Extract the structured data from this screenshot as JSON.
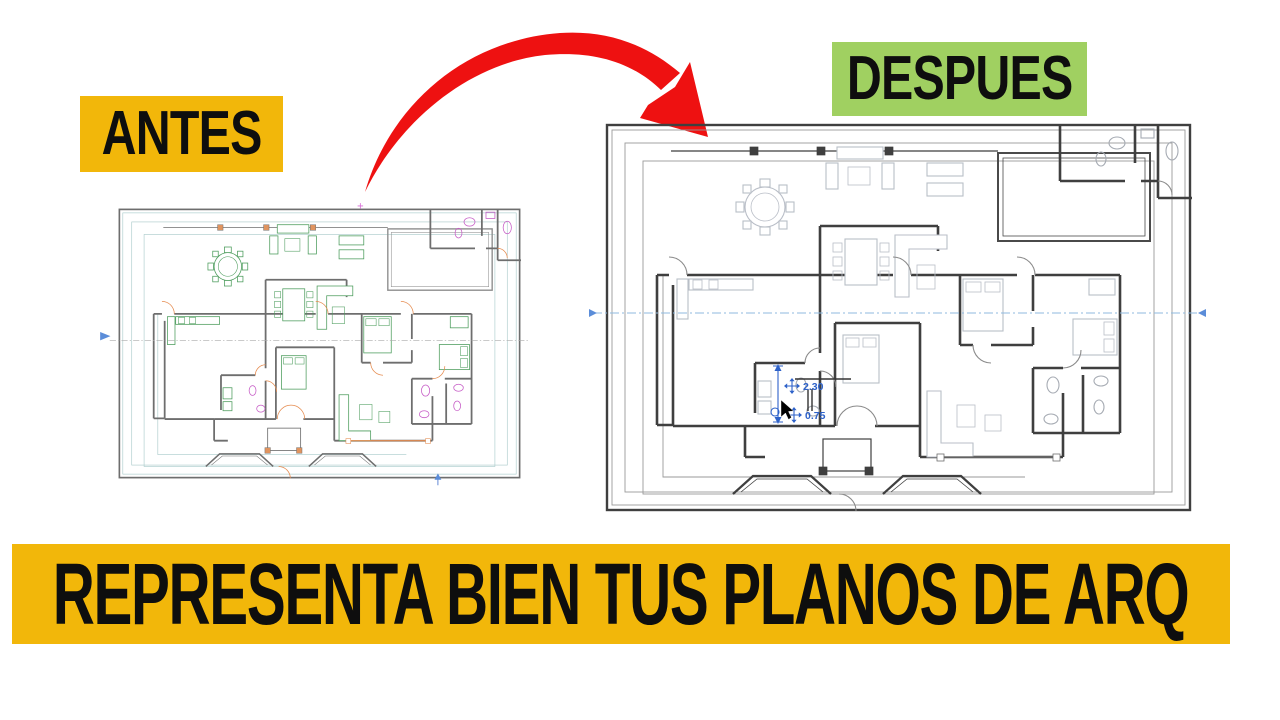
{
  "labels": {
    "before": "ANTES",
    "after": "DESPUES"
  },
  "banner": {
    "text": "REPRESENTA BIEN TUS PLANOS DE ARQ"
  },
  "plan_after": {
    "dim_width": "2.30",
    "dim_height": "0.75"
  },
  "icons": {
    "cursor": "arrow-pointer",
    "move_handle": "move-cross",
    "arrow": "curved-transform-arrow"
  },
  "colors": {
    "page_bg": "#FFFFFF",
    "accent_yellow": "#F2B70A",
    "accent_green": "#A0D061",
    "arrow_red": "#EE1111",
    "label_text": "#0E0E0E",
    "annotation_blue": "#2E62C9",
    "before_wall": "#6E6E6E",
    "before_boundary": "#A8CACA",
    "before_furniture": "#4C9C5C",
    "before_fixtures": "#C65BC6",
    "before_doors": "#E58B4F",
    "after_wall": "#3F3F3F",
    "after_boundary": "#9A9A9A",
    "after_furniture": "#B9BEC7"
  }
}
